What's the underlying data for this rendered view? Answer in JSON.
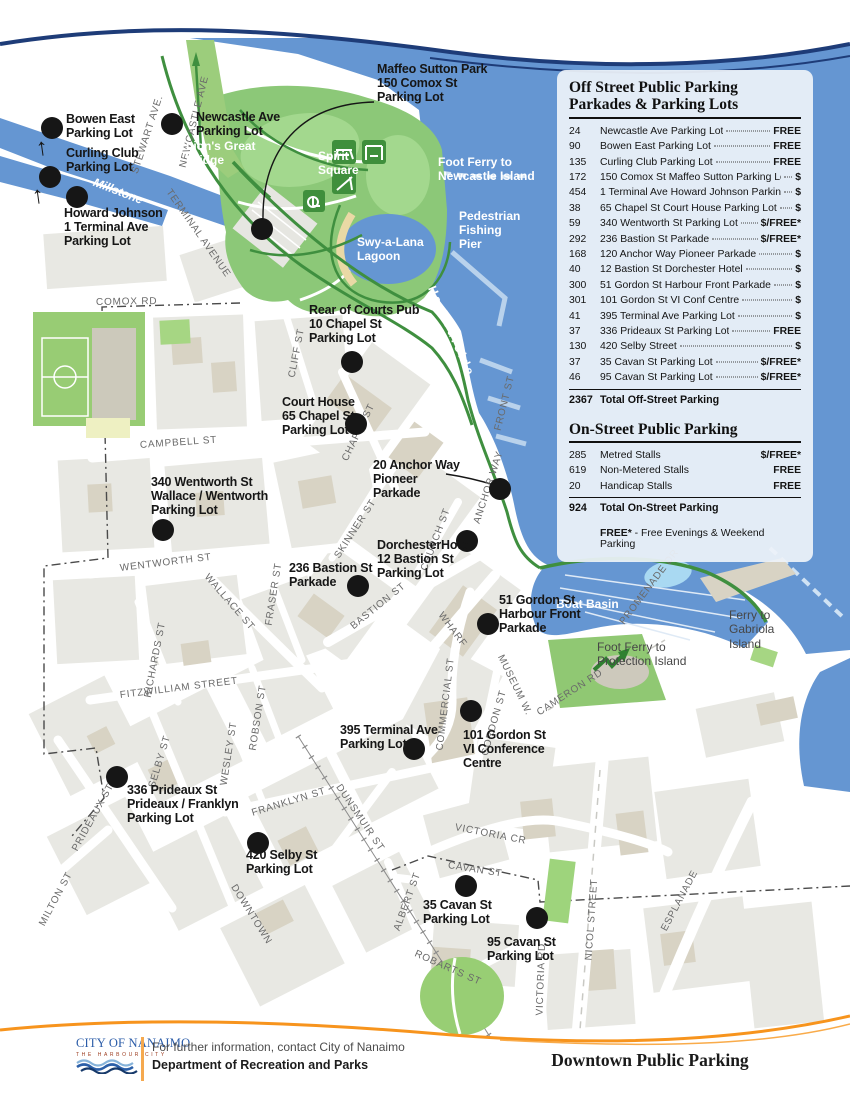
{
  "legend": {
    "off_street": {
      "title1": "Off Street Public Parking",
      "title2": "Parkades & Parking Lots",
      "rows": [
        {
          "n": "24",
          "name": "Newcastle Ave Parking Lot",
          "p": "FREE"
        },
        {
          "n": "90",
          "name": "Bowen East Parking Lot",
          "p": "FREE"
        },
        {
          "n": "135",
          "name": "Curling Club Parking Lot",
          "p": "FREE"
        },
        {
          "n": "172",
          "name": "150 Comox St Maffeo Sutton Parking Lot",
          "p": "$"
        },
        {
          "n": "454",
          "name": "1 Terminal Ave Howard Johnson Parking Lot",
          "p": "$"
        },
        {
          "n": "38",
          "name": "65 Chapel St Court House Parking Lot",
          "p": "$"
        },
        {
          "n": "59",
          "name": "340 Wentworth St Parking Lot",
          "p": "$/FREE*"
        },
        {
          "n": "292",
          "name": "236 Bastion St Parkade",
          "p": "$/FREE*"
        },
        {
          "n": "168",
          "name": "120 Anchor Way Pioneer Parkade",
          "p": "$"
        },
        {
          "n": "40",
          "name": "12 Bastion St Dorchester Hotel",
          "p": "$"
        },
        {
          "n": "300",
          "name": "51 Gordon St Harbour Front Parkade",
          "p": "$"
        },
        {
          "n": "301",
          "name": "101 Gordon St VI Conf Centre",
          "p": "$"
        },
        {
          "n": "41",
          "name": "395 Terminal Ave Parking Lot",
          "p": "$"
        },
        {
          "n": "37",
          "name": "336 Prideaux St Parking Lot",
          "p": "FREE"
        },
        {
          "n": "130",
          "name": "420 Selby Street",
          "p": "$"
        },
        {
          "n": "37",
          "name": "35 Cavan St Parking Lot",
          "p": "$/FREE*"
        },
        {
          "n": "46",
          "name": "95 Cavan St Parking Lot",
          "p": "$/FREE*"
        }
      ],
      "total_n": "2367",
      "total_label": "Total Off-Street Parking"
    },
    "on_street": {
      "title": "On-Street Public Parking",
      "rows": [
        {
          "n": "285",
          "name": "Metred Stalls",
          "p": "$/FREE*"
        },
        {
          "n": "619",
          "name": "Non-Metered Stalls",
          "p": "FREE"
        },
        {
          "n": "20",
          "name": "Handicap Stalls",
          "p": "FREE"
        }
      ],
      "total_n": "924",
      "total_label": "Total On-Street Parking",
      "note_bold": "FREE*",
      "note_rest": " - Free Evenings & Weekend Parking"
    }
  },
  "map": {
    "offmap_arrow": "↑",
    "parking_sites": [
      {
        "label": "Bowen East\nParking Lot"
      },
      {
        "label": "Curling Club\nParking Lot"
      },
      {
        "label": "Howard Johnson\n1 Terminal Ave\nParking Lot"
      },
      {
        "label": "Newcastle Ave\nParking Lot"
      },
      {
        "label": "Maffeo Sutton Park\n150 Comox St\nParking Lot"
      },
      {
        "label": "Rear of Courts Pub\n10 Chapel St\nParking Lot"
      },
      {
        "label": "Court House\n65 Chapel St\nParking Lot"
      },
      {
        "label": "20 Anchor Way\nPioneer\nParkade"
      },
      {
        "label": "340 Wentworth St\nWallace / Wentworth\nParking Lot"
      },
      {
        "label": "DorchesterHotel\n12 Bastion St\nParking Lot"
      },
      {
        "label": "236 Bastion St\nParkade"
      },
      {
        "label": "51 Gordon St\nHarbour Front\nParkade"
      },
      {
        "label": "395 Terminal Ave\nParking Lot"
      },
      {
        "label": "101 Gordon St\nVI Conference\nCentre"
      },
      {
        "label": "336 Prideaux St\nPrideaux / Franklyn\nParking Lot"
      },
      {
        "label": "420 Selby St\nParking Lot"
      },
      {
        "label": "35 Cavan St\nParking Lot"
      },
      {
        "label": "95 Cavan St\nParking Lot"
      }
    ],
    "streets": [
      "STEWART AVE.",
      "NEWCASTLE AVE",
      "TERMINAL AVENUE",
      "COMOX RD",
      "CAMPBELL ST",
      "CLIFF ST",
      "CHAPEL ST",
      "FRONT ST",
      "ANCHOR WAY",
      "WENTWORTH ST",
      "WALLACE ST",
      "FRASER ST",
      "SKINNER ST",
      "RICHARDS ST",
      "BASTION ST",
      "CHURCH ST",
      "WHARF",
      "FITZWILLIAM STREET",
      "ROBSON ST",
      "WESLEY ST",
      "SELBY ST",
      "COMMERCIAL ST",
      "GORDON ST",
      "MUSEUM W.",
      "CAMERON RD",
      "PRIDEAUX ST",
      "MILTON ST",
      "FRANKLYN ST",
      "DUNSMUIR ST",
      "VICTORIA CR",
      "DOWNTOWN",
      "CAVAN ST",
      "ALBERT ST",
      "ROBARTS ST",
      "NICOL STREET",
      "VICTORIA RD",
      "ESPLANADE",
      "PROMENADE DR"
    ],
    "water_labels": {
      "millstone": "Millstone",
      "lions_bridge": "Lion's Great\nBridge",
      "spirit_square": "Spirit\nSquare",
      "foot_ferry_newcastle": "Foot Ferry to\nNewcastle Island",
      "lagoon": "Swy-a-Lana\nLagoon",
      "fishing_pier": "Pedestrian\nFishing\nPier",
      "harbourside": "Harbourside",
      "boat_basin": "Boat Basin",
      "gabriola": "Ferry to\nGabriola\nIsland",
      "protection": "Foot Ferry to\nProtection Island"
    }
  },
  "footer": {
    "logo_line1": "CITY OF NANAIMO",
    "logo_line2": "THE  HARBOUR  CITY",
    "info1": "For further information, contact City of Nanaimo",
    "info2": "Department of Recreation and Parks",
    "doc_title": "Downtown Public Parking"
  }
}
